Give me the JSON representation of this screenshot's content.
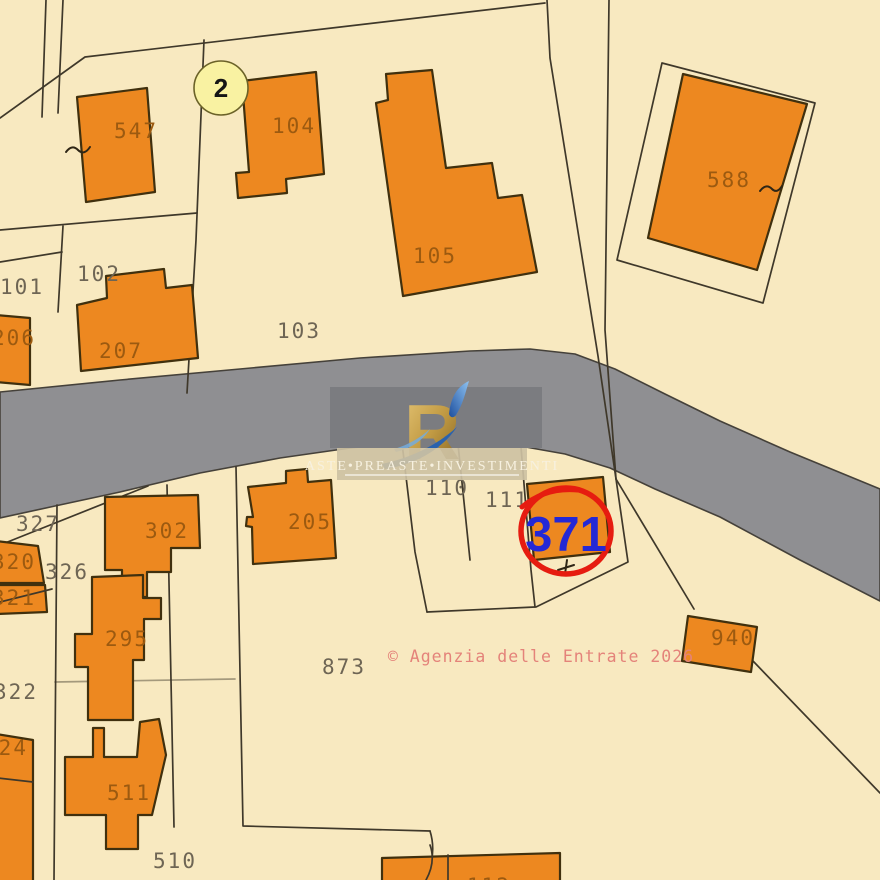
{
  "map_type": "cadastral-map",
  "colors": {
    "bg": "#f8e9c0",
    "road": "#8f8f92",
    "building": "#ed8820",
    "buildingStroke": "#40300e",
    "line": "#3f382a",
    "labelBuilding": "#9c5a10",
    "labelParcel": "#6e6554",
    "highlightRed": "#e61c10",
    "highlightBlue": "#2428d6",
    "markerYellow": "#f9f2a2",
    "watermarkGray": "#7b7c80",
    "watermarkTan": "#cdc1a3",
    "copyrightPink": "#e4837a"
  },
  "highlight": {
    "parcel": "371"
  },
  "marker": {
    "label": "2"
  },
  "watermark": {
    "brand": "ASTE•PREASTE•INVESTIMENTI",
    "logo_letter": "R",
    "copyright_note": "© Agenzia delle Entrate 2026"
  },
  "labels": [
    {
      "text": "547",
      "kind": "building"
    },
    {
      "text": "104",
      "kind": "building"
    },
    {
      "text": "105",
      "kind": "building"
    },
    {
      "text": "588",
      "kind": "building"
    },
    {
      "text": "206",
      "kind": "building"
    },
    {
      "text": "207",
      "kind": "building"
    },
    {
      "text": "302",
      "kind": "building"
    },
    {
      "text": "295",
      "kind": "building"
    },
    {
      "text": "511",
      "kind": "building"
    },
    {
      "text": "320",
      "kind": "building"
    },
    {
      "text": "321",
      "kind": "building"
    },
    {
      "text": "324",
      "kind": "building"
    },
    {
      "text": "205",
      "kind": "building"
    },
    {
      "text": "940",
      "kind": "building"
    },
    {
      "text": "112",
      "kind": "building"
    },
    {
      "text": "101",
      "kind": "parcel"
    },
    {
      "text": "102",
      "kind": "parcel"
    },
    {
      "text": "103",
      "kind": "parcel"
    },
    {
      "text": "110",
      "kind": "parcel"
    },
    {
      "text": "111",
      "kind": "parcel"
    },
    {
      "text": "327",
      "kind": "parcel"
    },
    {
      "text": "326",
      "kind": "parcel"
    },
    {
      "text": "322",
      "kind": "parcel"
    },
    {
      "text": "510",
      "kind": "parcel"
    },
    {
      "text": "873",
      "kind": "parcel"
    }
  ]
}
